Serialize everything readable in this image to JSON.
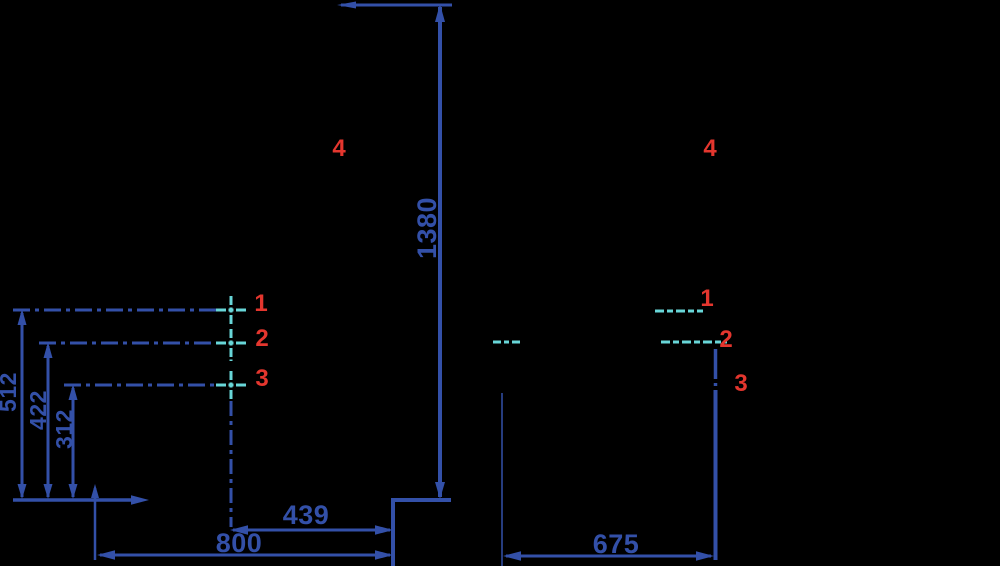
{
  "colors": {
    "background": "#000000",
    "blue": "#3350a8",
    "cyan": "#68d6d8",
    "red": "#e4362e"
  },
  "side_view": {
    "overall_height": "1380",
    "seat_depth": "439",
    "base_depth": "800",
    "point1": {
      "label": "1",
      "height": "512"
    },
    "point2": {
      "label": "2",
      "height": "422"
    },
    "point3": {
      "label": "3",
      "height": "312"
    },
    "point4": {
      "label": "4"
    }
  },
  "front_view": {
    "width": "675",
    "point1": {
      "label": "1"
    },
    "point2": {
      "label": "2"
    },
    "point3": {
      "label": "3"
    },
    "point4": {
      "label": "4"
    }
  }
}
